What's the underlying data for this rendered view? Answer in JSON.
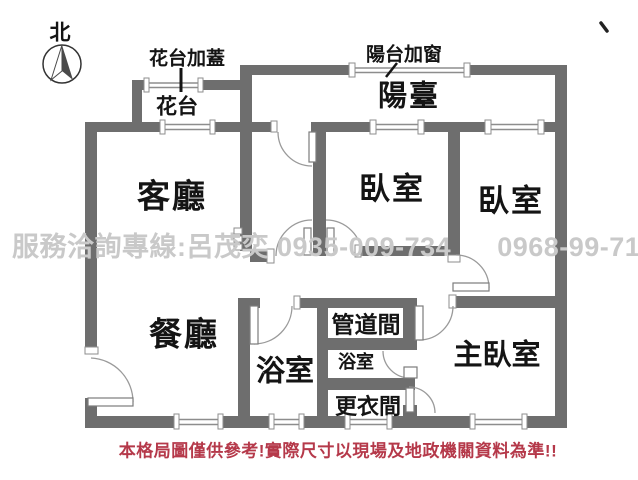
{
  "compass": {
    "north_label": "北"
  },
  "annotations": {
    "flower_cover": "花台加蓋",
    "balcony_window": "陽台加窗"
  },
  "rooms": {
    "flower_bed": "花台",
    "balcony": "陽臺",
    "living": "客廳",
    "bedroom_a": "臥室",
    "bedroom_b": "臥室",
    "dining": "餐廳",
    "bathroom_main": "浴室",
    "pipe_duct": "管道間",
    "bathroom_small": "浴室",
    "dressing": "更衣間",
    "master": "主臥室"
  },
  "watermark": {
    "service_line": "服務洽詢專線:呂茂奕",
    "phone1": "0935-009-734",
    "phone2": "0968-99-71-75"
  },
  "disclaimer": "本格局圖僅供參考!實際尺寸以現場及地政機關資料為準!!",
  "colors": {
    "wall": "#6e6e6e",
    "label": "#141414",
    "watermark": "#c9c9c9",
    "disclaimer": "#b5394a"
  }
}
